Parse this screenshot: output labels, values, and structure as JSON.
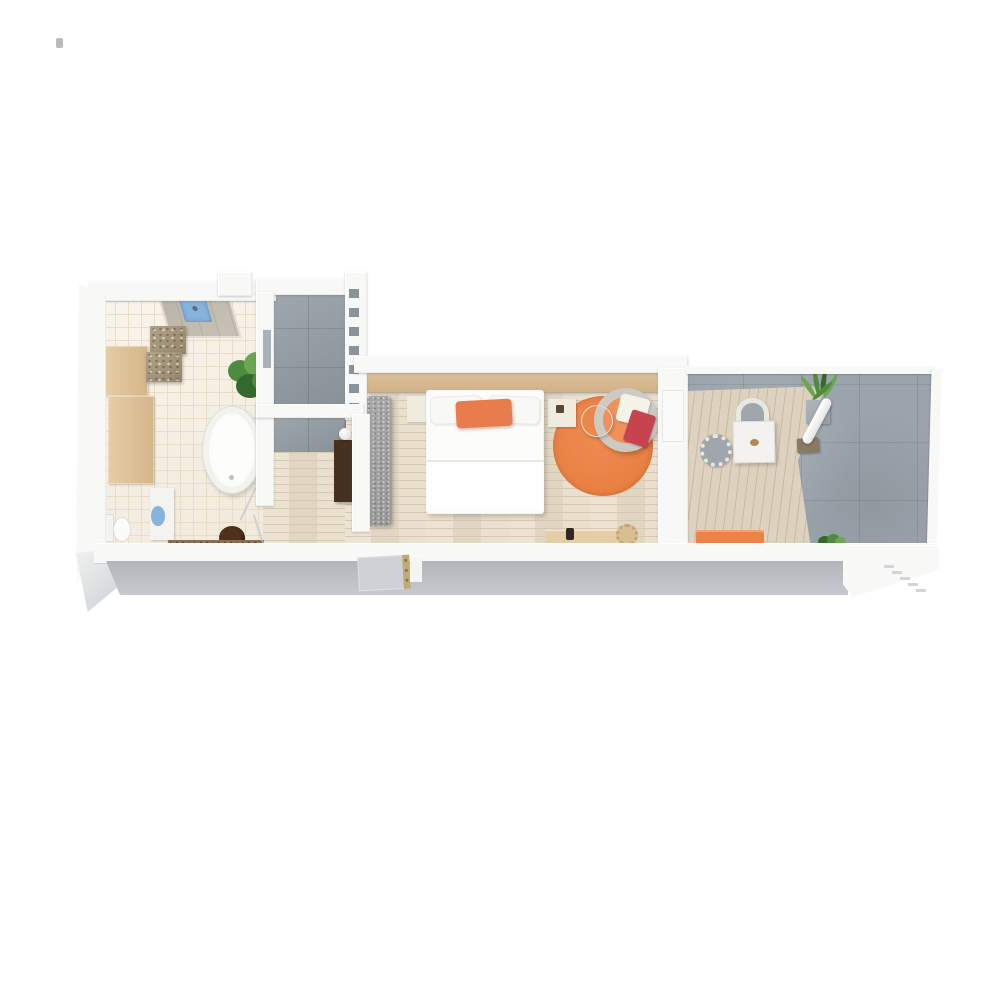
{
  "scene": {
    "type": "3d-floor-plan-render",
    "view": "top-down",
    "background": "#ffffff",
    "rooms": [
      {
        "name": "bathroom",
        "floor": "cream-ceramic-tile",
        "items": [
          "walk-in-shower",
          "blue-shower-mat",
          "stone-block-bench",
          "storage-cabinet",
          "sideboard",
          "potted-plant",
          "freestanding-oval-bathtub",
          "toilet",
          "blue-washbasin-vanity",
          "dark-round-stool",
          "stone-countertop",
          "glass-partition"
        ]
      },
      {
        "name": "entry-hall",
        "floor": "gray-stone-tile",
        "items": [
          "perforated-partition-wall",
          "window-slit",
          "dark-wardrobe",
          "sphere-lamp",
          "entry-door"
        ]
      },
      {
        "name": "bedroom",
        "floor": "light-oak-plank",
        "items": [
          "wood-headboard-wall",
          "double-bed",
          "white-pillow-left",
          "white-pillow-right",
          "orange-accent-pillow",
          "nightstand-left",
          "nightstand-right",
          "upholstered-bench",
          "orange-round-rug",
          "gray-lounge-chair",
          "orange-seat-cushion",
          "white-throw-pillow",
          "red-throw-pillow",
          "round-side-table",
          "desk",
          "desk-lamp",
          "rattan-chair"
        ]
      },
      {
        "name": "balcony",
        "floor": "concrete-tile-with-wood-deck",
        "items": [
          "outdoor-dining-table",
          "wicker-chair",
          "round-wicker-chair",
          "grass-planter",
          "tilted-outdoor-lamp",
          "orange-bench",
          "small-plant",
          "parapet-wall"
        ]
      }
    ]
  },
  "palette": {
    "wall": "#f8f8f7",
    "wallFace": "#c6c9ce",
    "wallFaceDark": "#b2b6bc",
    "bathTile": "#f6eee0",
    "bathGrout": "#e9ddc8",
    "grayTile": "#949da5",
    "grayTileDark": "#8a929a",
    "concrete": "#9ba4ac",
    "wood": "#e9decb",
    "woodLine": "#d7c8b1",
    "deck": "#ddd2bf",
    "deckLine": "#c9baa1",
    "tan": "#e6cda6",
    "tanDark": "#d4b588",
    "headboard": "#dcc09a",
    "stone": "#b2a28a",
    "stoneDark": "#958569",
    "green": "#4e8a3f",
    "greenLight": "#6aa74f",
    "greenDark": "#35682c",
    "tubWhite": "#fdfdfc",
    "porcelain": "#f3f3f1",
    "blue": "#85b3dc",
    "stool": "#50311c",
    "counter": "#8d6f52",
    "benchGray": "#a6a6a6",
    "wardrobe": "#46301f",
    "bedWhite": "#fcfcfb",
    "pillowOrange": "#e87c4d",
    "rugOrange": "#ef8b50",
    "chairGray": "#cdcac4",
    "cushionOrange": "#f0915a",
    "pillowRed": "#c84350",
    "pillowWhite": "#f5f2e8",
    "cream": "#f0ebdf",
    "deskTan": "#e5cea6",
    "rattan": "#d8bf92",
    "outTable": "#f3f2f0",
    "wicker": "#e9e7e1",
    "wickerSeat": "#9fa7ad",
    "outBench": "#ee8347",
    "doorPanel": "#ced2d6",
    "hinge": "#c3a878",
    "glass": "rgba(190,200,206,0.7)"
  }
}
